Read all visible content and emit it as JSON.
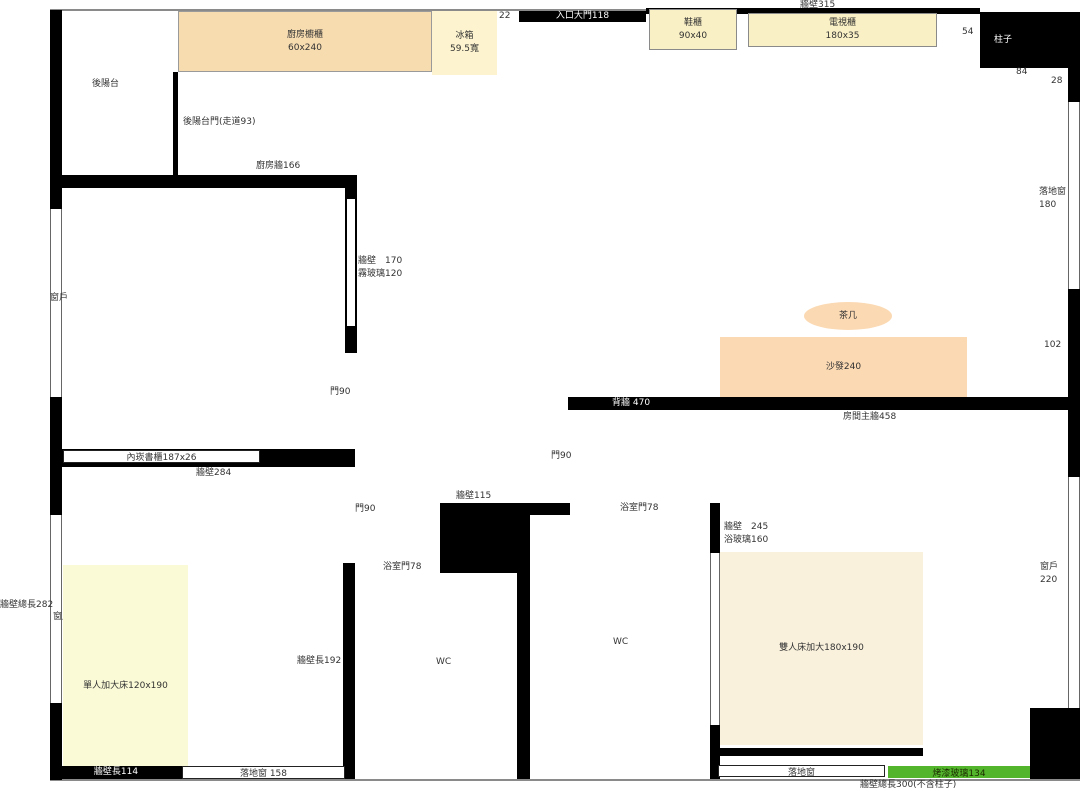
{
  "colors": {
    "wall": "#000000",
    "line": "#8a8a8a",
    "text": "#333333",
    "tan": "#f7dcb0",
    "pale_yellow": "#faf0c5",
    "fridge_yellow": "#fdf4cf",
    "peach": "#fbd9b3",
    "cream": "#faf1dc",
    "bed_yellow": "#fafad6",
    "green": "#53b52c"
  },
  "walls": {
    "wall315": "牆壁315",
    "entry_door": "入口大門118",
    "seg22": "22",
    "seg54": "54",
    "pillar": "柱子",
    "seg84": "84",
    "seg28": "28",
    "kitchen_wall": "廚房牆166",
    "balcony_door": "後陽台門(走道93)",
    "frost_wall": "牆壁　170",
    "frost_glass": "霧玻璃120",
    "back_wall": "背牆 470",
    "main_wall": "房間主牆458",
    "seg102": "102",
    "wall284": "牆壁284",
    "wall115": "牆壁115",
    "wall245": "牆壁　245",
    "bath_glass": "浴玻璃160",
    "wall192": "牆壁長192",
    "wall114": "牆壁長114",
    "total282": "牆壁總長282",
    "total300": "牆壁總長300(不含柱子)"
  },
  "doors": {
    "living_door": "門90",
    "hall_door": "門90",
    "study_door": "門90",
    "bath_door_left": "浴室門78",
    "bath_door_right": "浴室門78"
  },
  "windows": {
    "left_window": "窗戶",
    "left_window178": "窗戶178",
    "right_window_l1": "落地窗",
    "right_window_l2": "180",
    "right_window2_l1": "窗戶",
    "right_window2_l2": "220",
    "bottom_window158": "落地窗 158",
    "bottom_window": "落地窗",
    "painted_glass": "烤漆玻璃134"
  },
  "rooms": {
    "balcony": "後陽台",
    "wc1": "WC",
    "wc2": "WC"
  },
  "furniture": {
    "kitchen_cabinet": "廚房櫥櫃",
    "kitchen_cabinet_size": "60x240",
    "fridge": "冰箱",
    "fridge_size": "59.5寬",
    "shoe_cabinet": "鞋櫃",
    "shoe_cabinet_size": "90x40",
    "tv_cabinet": "電視櫃",
    "tv_cabinet_size": "180x35",
    "tea_table": "茶几",
    "sofa": "沙發240",
    "double_bed": "雙人床加大180x190",
    "single_bed": "單人加大床120x190",
    "bookcase": "內崁書櫃187x26"
  }
}
